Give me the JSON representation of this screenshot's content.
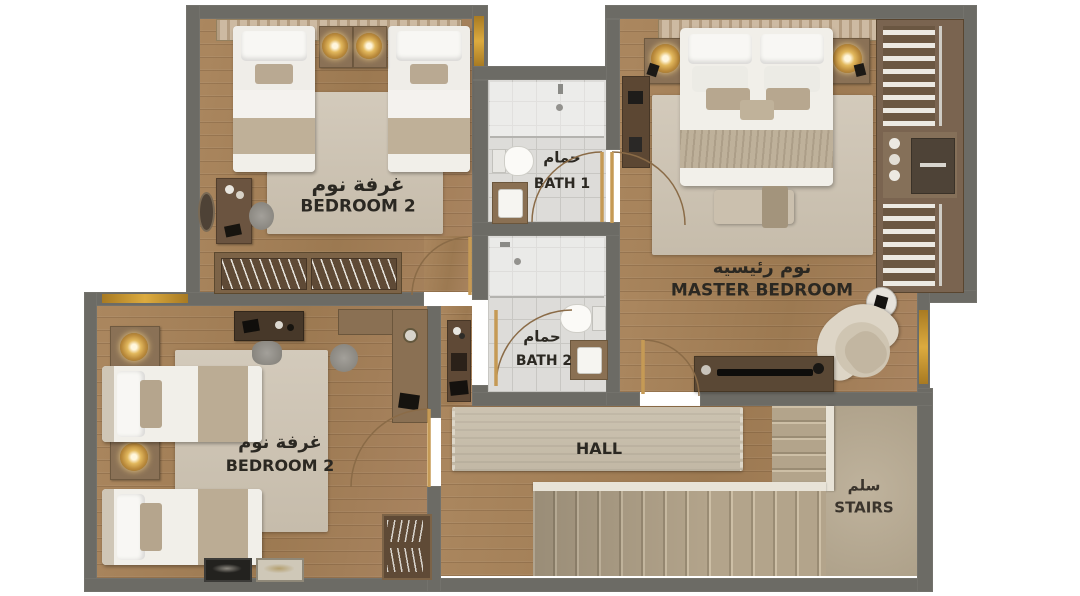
{
  "plan": {
    "rooms": {
      "bedroom2_top": {
        "ar": "غرفة نوم",
        "en": "BEDROOM 2"
      },
      "bath1": {
        "ar": "حمام",
        "en": "BATH 1"
      },
      "bath2": {
        "ar": "حمام",
        "en": "BATH 2"
      },
      "master_bedroom": {
        "ar": "نوم رئيسيه",
        "en": "MASTER BEDROOM"
      },
      "bedroom2_bottom": {
        "ar": "غرفة نوم",
        "en": "BEDROOM 2"
      },
      "hall": {
        "en": "HALL"
      },
      "stairs": {
        "ar": "سلم",
        "en": "STAIRS"
      }
    },
    "colors": {
      "wall": "#6c6b65",
      "wood_floor": "#a5815c",
      "bath_tile": "#dddcd9",
      "rug": "#cdc4b4",
      "stair_carpet": "#b6a88f",
      "window_gold": "#dcab3f",
      "label_text": "#2b2822"
    }
  }
}
